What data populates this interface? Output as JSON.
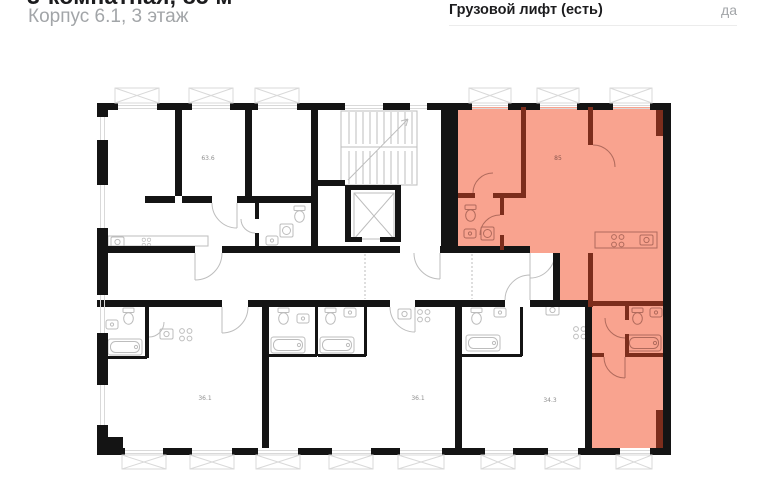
{
  "header": {
    "title": "3-комнатная, 85 м²",
    "subtitle": "Корпус 6.1, 3 этаж",
    "right_label": "Грузовой лифт (есть)",
    "right_value": "да"
  },
  "floorplan": {
    "labels": {
      "apt_85": "85",
      "apt_63": "63.6",
      "apt_36a": "36.1",
      "apt_36b": "36.1",
      "apt_34": "34.3"
    }
  },
  "colors": {
    "wall": "#141414",
    "highlight": "#f9a38f",
    "highlight_wall": "#7c2d1c",
    "fixture": "#bdbdbd",
    "fixture_red": "#b06a5c",
    "window": "#d9d9d9",
    "label": "#8f8f8f",
    "label_red": "#8a564e",
    "divider": "#ececec",
    "text_primary": "#1c1c1e",
    "text_secondary": "#a2a5a8"
  }
}
